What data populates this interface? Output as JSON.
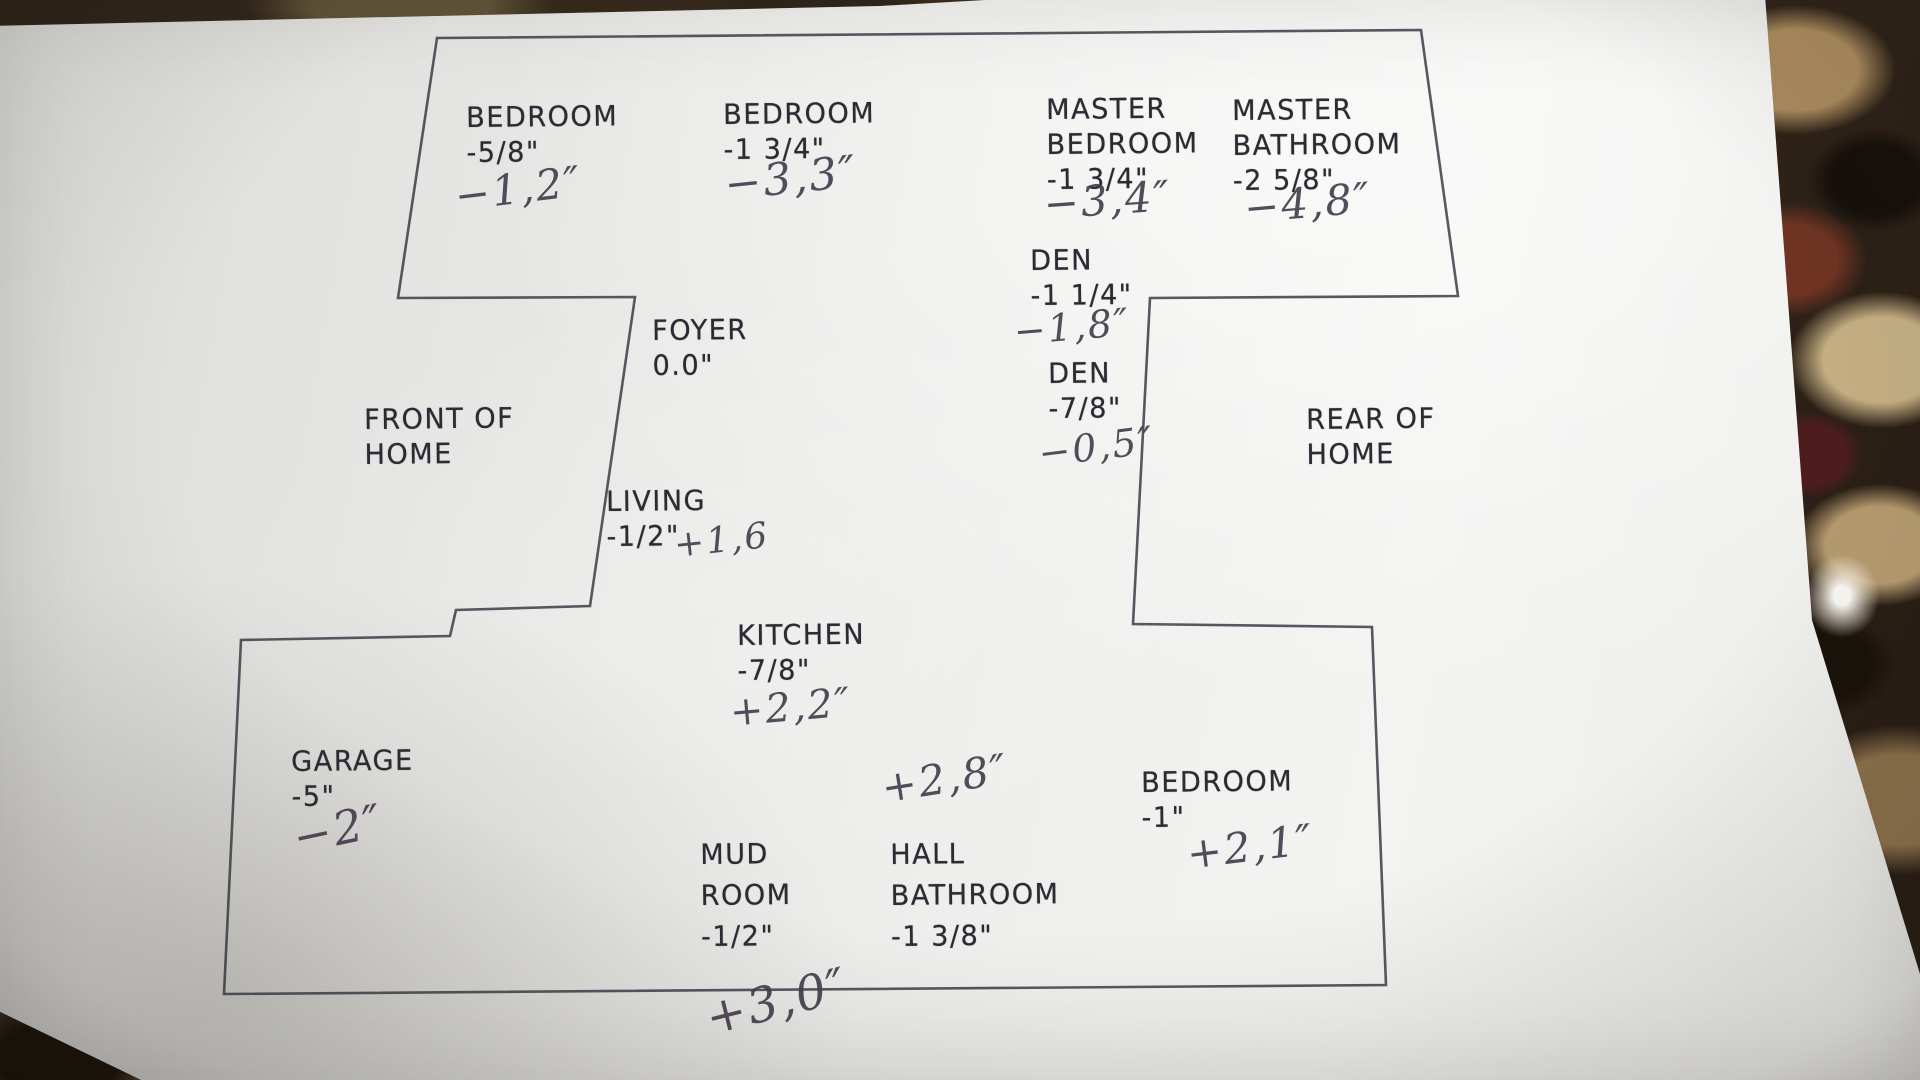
{
  "colors": {
    "paper": "#efefed",
    "printed_ink": "#2b2b34",
    "pen_ink": "#453e4e",
    "outline_line": "#41414b",
    "granite_base": "#2c2218",
    "granite_tan": "#b49a6e",
    "glare": "#fffdf8"
  },
  "plan": {
    "orientation": {
      "front": {
        "line1": "FRONT OF",
        "line2": "HOME"
      },
      "rear": {
        "line1": "REAR OF",
        "line2": "HOME"
      }
    },
    "rooms": {
      "bedroom_left": {
        "name": "BEDROOM",
        "printed": "-5/8\"",
        "written": "−1,2″"
      },
      "bedroom_mid": {
        "name": "BEDROOM",
        "printed": "-1 3/4\"",
        "written": "−3,3″"
      },
      "master_bedroom": {
        "name_line1": "MASTER",
        "name_line2": "BEDROOM",
        "printed": "-1 3/4\"",
        "written": "−3,4″"
      },
      "master_bathroom": {
        "name_line1": "MASTER",
        "name_line2": "BATHROOM",
        "printed": "-2 5/8\"",
        "written": "−4,8″"
      },
      "den_upper": {
        "name": "DEN",
        "printed": "-1 1/4\"",
        "written": "−1,8″"
      },
      "den_lower": {
        "name": "DEN",
        "printed": "-7/8\"",
        "written": "−0,5″"
      },
      "foyer": {
        "name": "FOYER",
        "printed": "0.0\""
      },
      "living": {
        "name": "LIVING",
        "printed": "-1/2\"",
        "written": "+1,6"
      },
      "kitchen": {
        "name": "KITCHEN",
        "printed": "-7/8\"",
        "written": "+2,2″"
      },
      "garage": {
        "name": "GARAGE",
        "printed": "-5\"",
        "written": "−2″"
      },
      "mud_room": {
        "name_line1": "MUD",
        "name_line2": "ROOM",
        "printed": "-1/2\""
      },
      "hall_bathroom": {
        "name_line1": "HALL",
        "name_line2": "BATHROOM",
        "printed": "-1 3/8\"",
        "written": "+2,8″"
      },
      "bedroom_rear": {
        "name": "BEDROOM",
        "printed": "-1\"",
        "written": "+2,1″"
      },
      "bottom_note": {
        "written": "+3,0″"
      }
    }
  }
}
